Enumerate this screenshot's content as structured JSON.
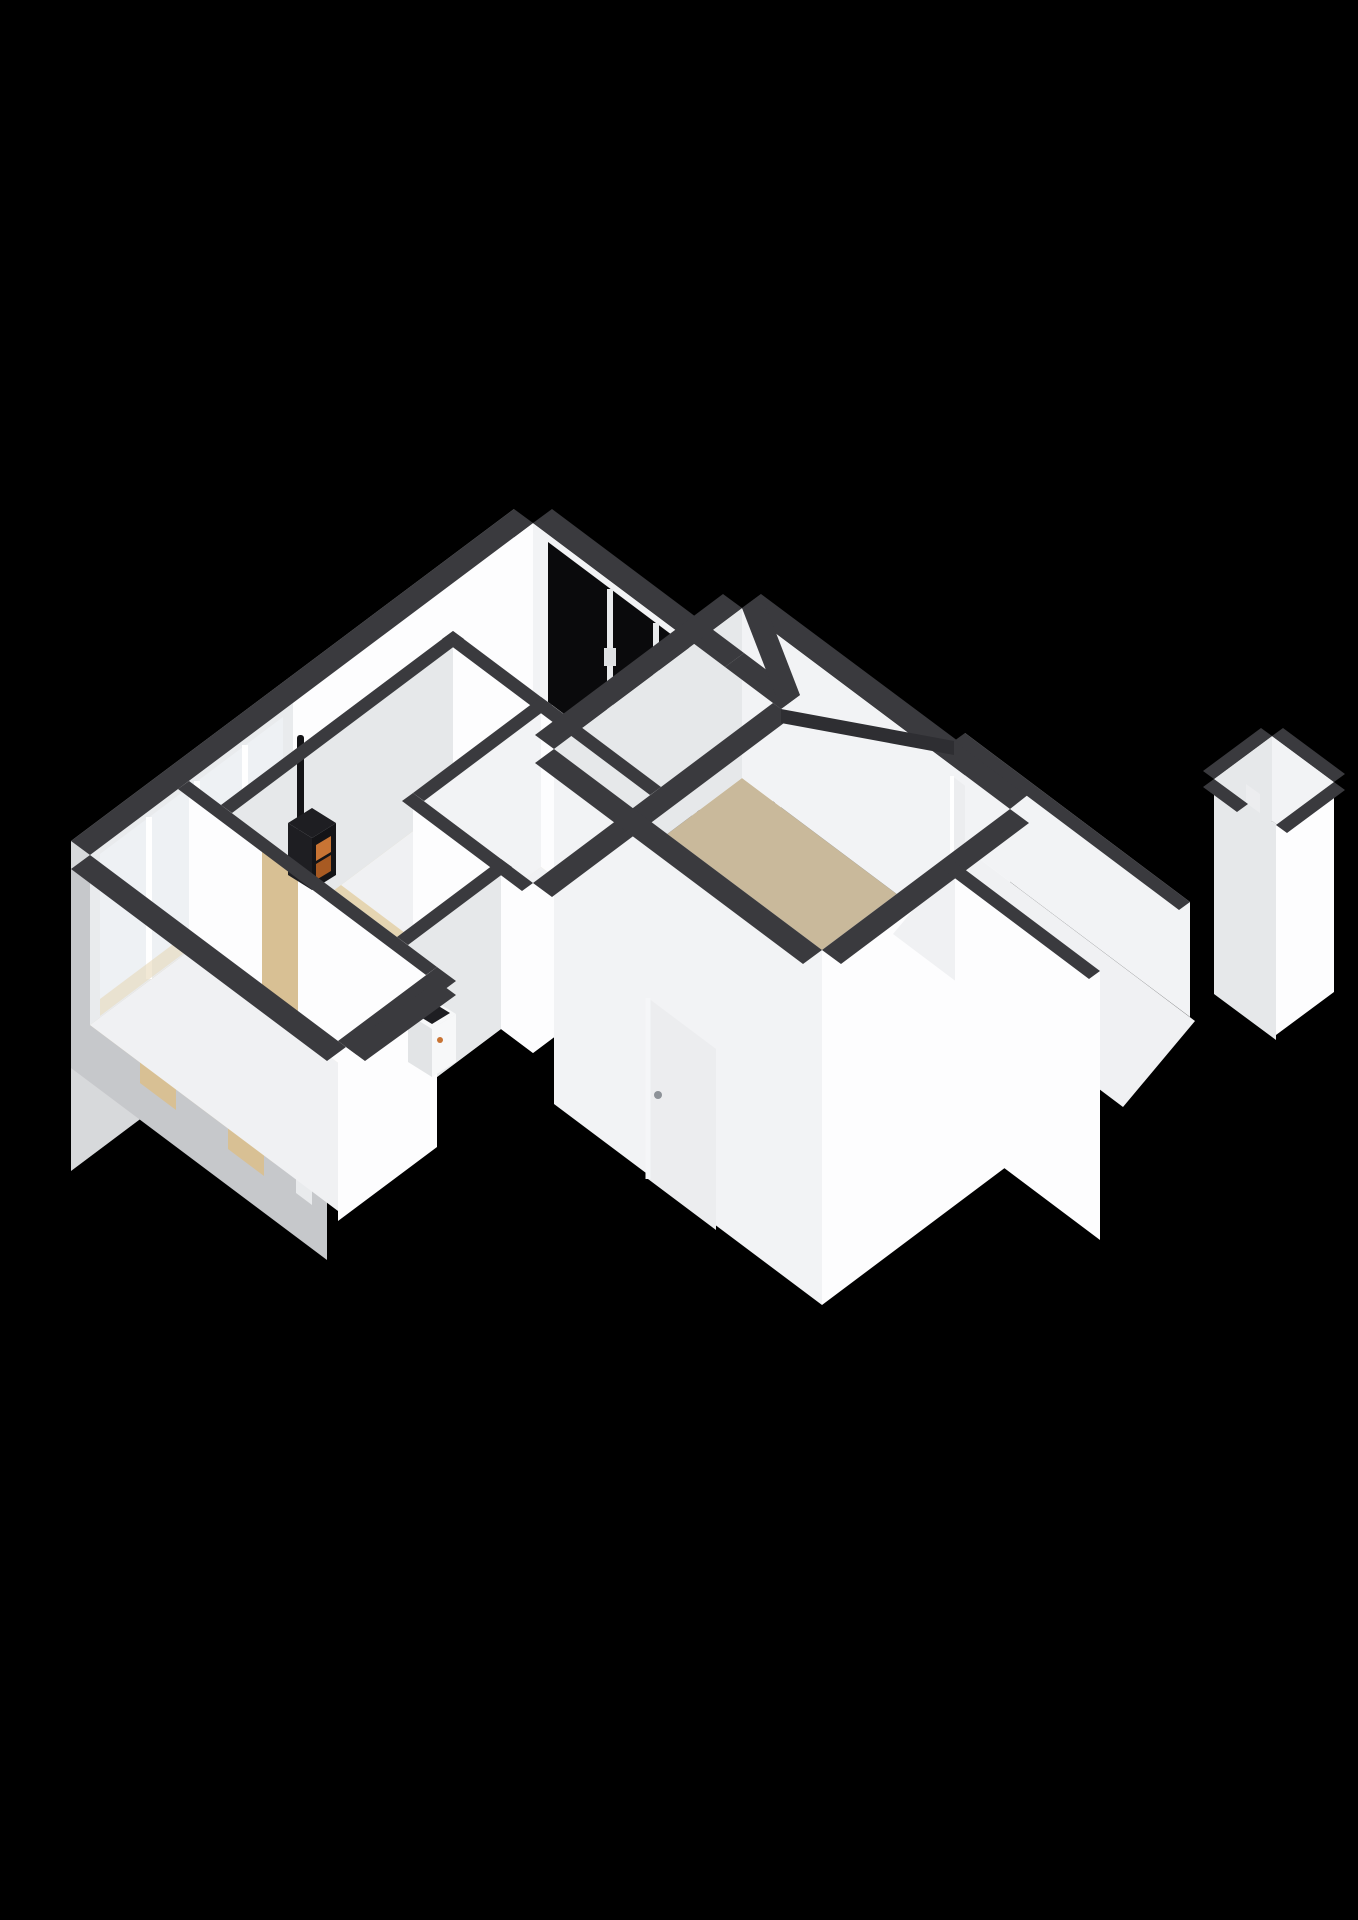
{
  "scene": {
    "type": "isometric-3d-floorplan-render",
    "background": "#000000",
    "style": "white walls with dark-grey cut tops, seen from above at an angle"
  },
  "colors": {
    "background": "#000000",
    "wallBand": "#3a3a3e",
    "wallBandDark": "#2e2e32",
    "wallWhite": "#fdfdfe",
    "wallLight": "#f2f3f5",
    "wallShade": "#e6e8ea",
    "wallExterior": "#d7d9db",
    "wallExteriorDark": "#c6c8cb",
    "floorLiving": "#e5d5b2",
    "floorBedroom": "#c9b99b",
    "floorKitchen": "#dde4eb",
    "floorHall": "#f0f1f3",
    "floorShower": "#c8d6e2",
    "floorSmallRoom": "#eff1f3",
    "glassDark": "#0a0a0c",
    "glassLight": "#eef1f4",
    "glassBlue": "#aebfd0",
    "frameWhite": "#e9ebed",
    "counterBlack": "#121215",
    "cabinetWhite": "#f5f6f7",
    "cabinetSide": "#e2e4e6",
    "sinkSteel": "#c3c7cc",
    "sinkInner": "#8f959b",
    "stoveBlack": "#141417",
    "stoveSide": "#1e1e22",
    "fireOrange": "#c87434",
    "fireEmber": "#a85a22",
    "doorTan": "#d8c094",
    "doorWhite": "#ecedef",
    "applianceWhite": "#f7f8f9"
  },
  "rooms": [
    {
      "name": "living-room",
      "floor": "floorLiving",
      "features": [
        "wood-stove",
        "window-wall-left",
        "window-wall-top"
      ]
    },
    {
      "name": "kitchen",
      "floor": "floorKitchen",
      "features": [
        "black-counter",
        "sink",
        "entry-door"
      ]
    },
    {
      "name": "bathroom",
      "floor": "floorHall",
      "features": [
        "shower-corner",
        "tan-door"
      ]
    },
    {
      "name": "toilet",
      "floor": "floorHall",
      "features": []
    },
    {
      "name": "utility-closet",
      "floor": "floorHall",
      "features": [
        "washing-machine"
      ]
    },
    {
      "name": "hallway",
      "floor": "floorHall",
      "features": [
        "tan-doors"
      ]
    },
    {
      "name": "bedroom",
      "floor": "floorBedroom",
      "features": [
        "interior-door",
        "exterior-door"
      ]
    },
    {
      "name": "walkway-balcony",
      "floor": "floorHall",
      "features": [
        "open-edge"
      ]
    },
    {
      "name": "storage-room",
      "floor": "floorSmallRoom",
      "features": [
        "narrow-door"
      ]
    }
  ],
  "objects": [
    {
      "name": "wood-stove",
      "detail": "black stove with tall flue pipe and orange fire glow"
    },
    {
      "name": "kitchen-counter",
      "detail": "black worktop, white cabinet fronts, steel sink with faucet"
    },
    {
      "name": "washing-machine",
      "detail": "white box appliance in utility closet"
    }
  ],
  "openings": {
    "dark_window_panes_top_wall": 3,
    "entry_door_dark_glass": 1,
    "light_window_panes_left_wall": 4,
    "tan_interior_doors": 4,
    "white_doors": 3
  }
}
